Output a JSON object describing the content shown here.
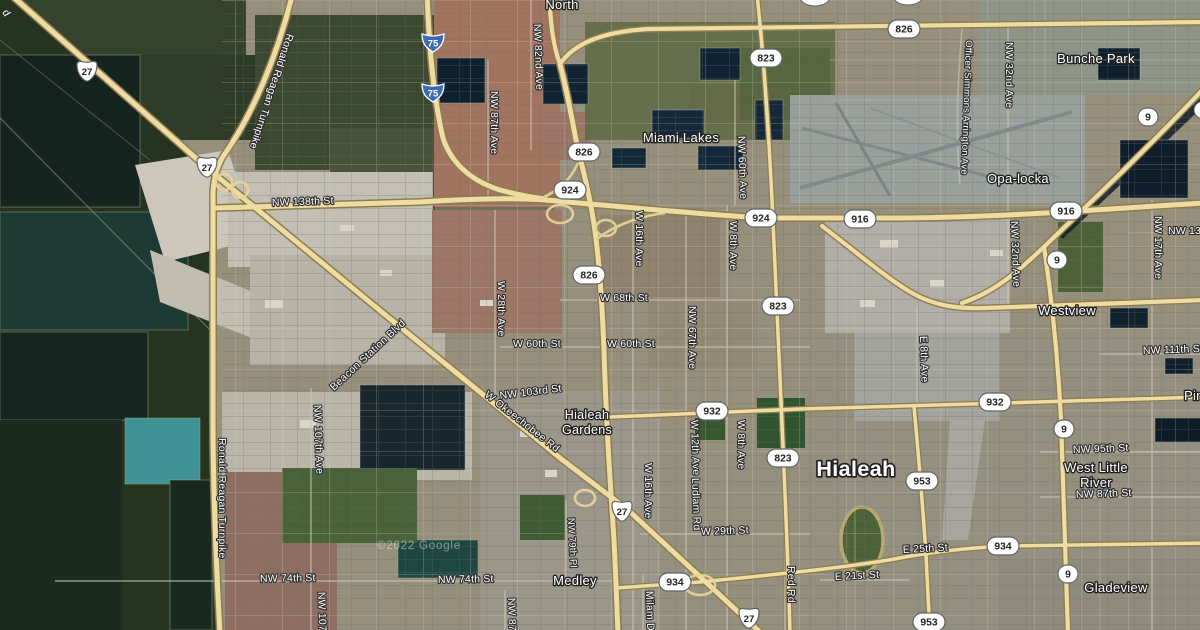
{
  "map": {
    "attribution": "©2022 Google",
    "places": {
      "partial_top": "North",
      "miami_lakes": "Miami Lakes",
      "bunche_park": "Bunche Park",
      "opa_locka": "Opa-locka",
      "westview": "Westview",
      "hialeah_gardens_l1": "Hialeah",
      "hialeah_gardens_l2": "Gardens",
      "hialeah": "Hialeah",
      "medley": "Medley",
      "west_little_river_l1": "West Little",
      "west_little_river_l2": "River",
      "gladeview": "Gladeview",
      "pinewood_partial": "Pin"
    },
    "roads": {
      "turnpike": "Ronald Reagan Turnpike",
      "nw138": "NW 138th St",
      "nw82ave": "NW 82nd Ave",
      "nw87ave": "NW 87th Ave",
      "nw60ave": "NW 60th Ave",
      "officer_simmons": "Officer Simmons Arrington Ave",
      "nw32ave": "NW 32nd Ave",
      "nw17ave": "NW 17th Ave",
      "nw131_partial": "NW 131",
      "w28ave": "W 28th Ave",
      "w16ave": "W 16th Ave",
      "w8ave": "W 8th Ave",
      "nw67ave": "NW 67th Ave",
      "w68st": "W 68th St",
      "w60st": "W 60th St",
      "nw103st": "NW 103rd St",
      "okeechobee": "W Okeechobee Rd",
      "beacon": "Beacon Station Blvd",
      "nw107ave": "NW 107th Ave",
      "nw107_partial": "NW 107t",
      "w12ave": "W 12th Ave",
      "ludlam": "Ludlam Rd",
      "e8ave": "E 8th Ave",
      "nw111st": "NW 111th St",
      "w29st": "W 29th St",
      "nw79pl": "NW 79th Pl",
      "red_rd": "Red Rd",
      "nw74st": "NW 74th St",
      "e25st": "E 25th St",
      "e21st": "E 21st St",
      "nw95st": "NW 95th St",
      "nw87st": "NW 87th St",
      "milam_partial": "Milam D",
      "nw87_partial": "NW 87t",
      "edge_partial": "d"
    },
    "shields": {
      "i75": "75",
      "us27": "27",
      "sr826": "826",
      "sr924": "924",
      "sr823": "823",
      "sr916": "916",
      "sr9": "9",
      "sr932": "932",
      "sr934": "934",
      "sr953": "953"
    }
  }
}
